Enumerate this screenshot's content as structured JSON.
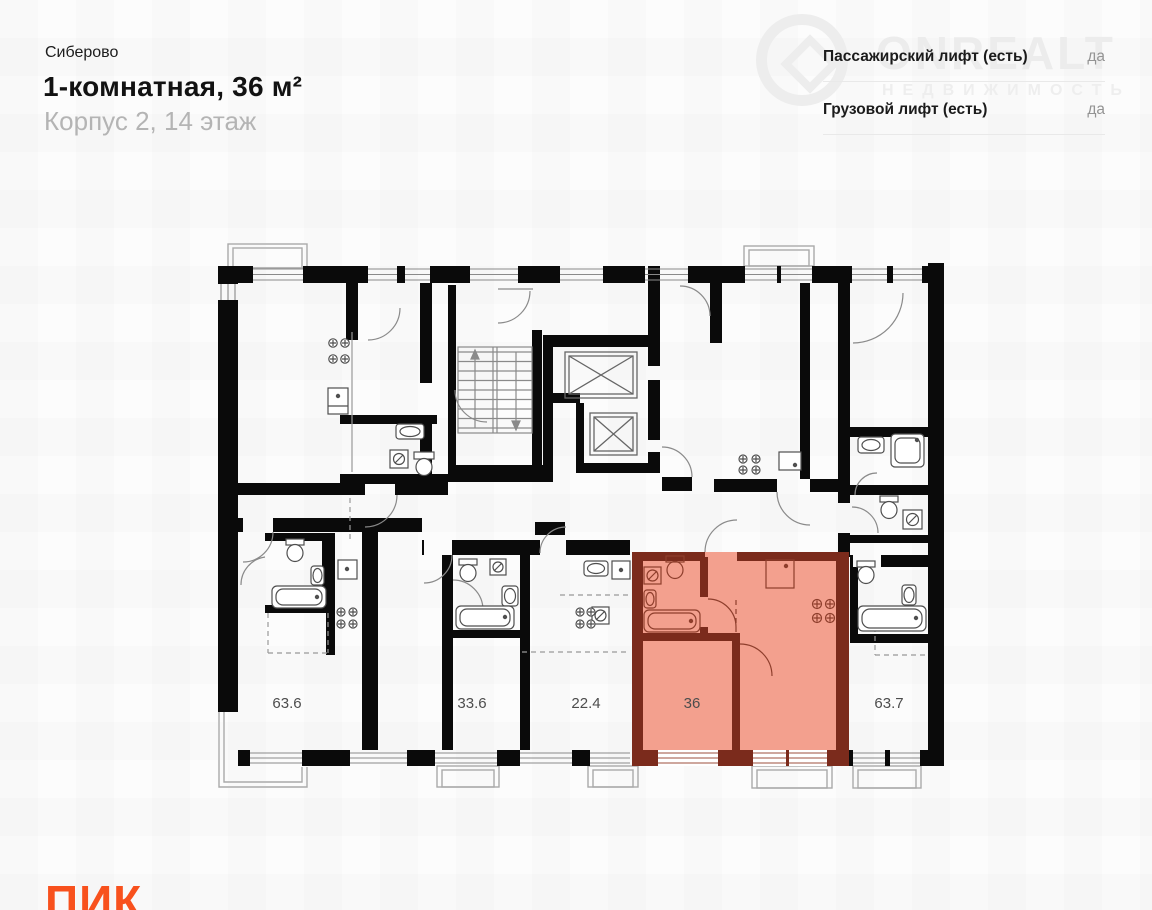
{
  "header": {
    "project": "Сиберово",
    "title": "1-комнатная, 36 м²",
    "subtitle": "Корпус 2, 14 этаж"
  },
  "info_panel": {
    "rows": [
      {
        "label": "Пассажирский лифт (есть)",
        "value": "да"
      },
      {
        "label": "Грузовой лифт (есть)",
        "value": "да"
      }
    ]
  },
  "watermark": {
    "brand": "ONREALT",
    "subtitle": "НЕДВИЖИМОСТЬ"
  },
  "plan": {
    "apartments": [
      {
        "label": "63.6",
        "highlighted": false
      },
      {
        "label": "33.6",
        "highlighted": false
      },
      {
        "label": "22.4",
        "highlighted": false
      },
      {
        "label": "36",
        "highlighted": true
      },
      {
        "label": "63.7",
        "highlighted": false
      }
    ],
    "colors": {
      "wall": "#0a0a0a",
      "thin_line": "#8a8a8a",
      "highlight_fill": "#F3A08E",
      "highlight_wall": "#7B2B1C",
      "highlight_line": "#93422F"
    }
  },
  "logo": {
    "text": "ПИК",
    "color": "#F8511D"
  }
}
